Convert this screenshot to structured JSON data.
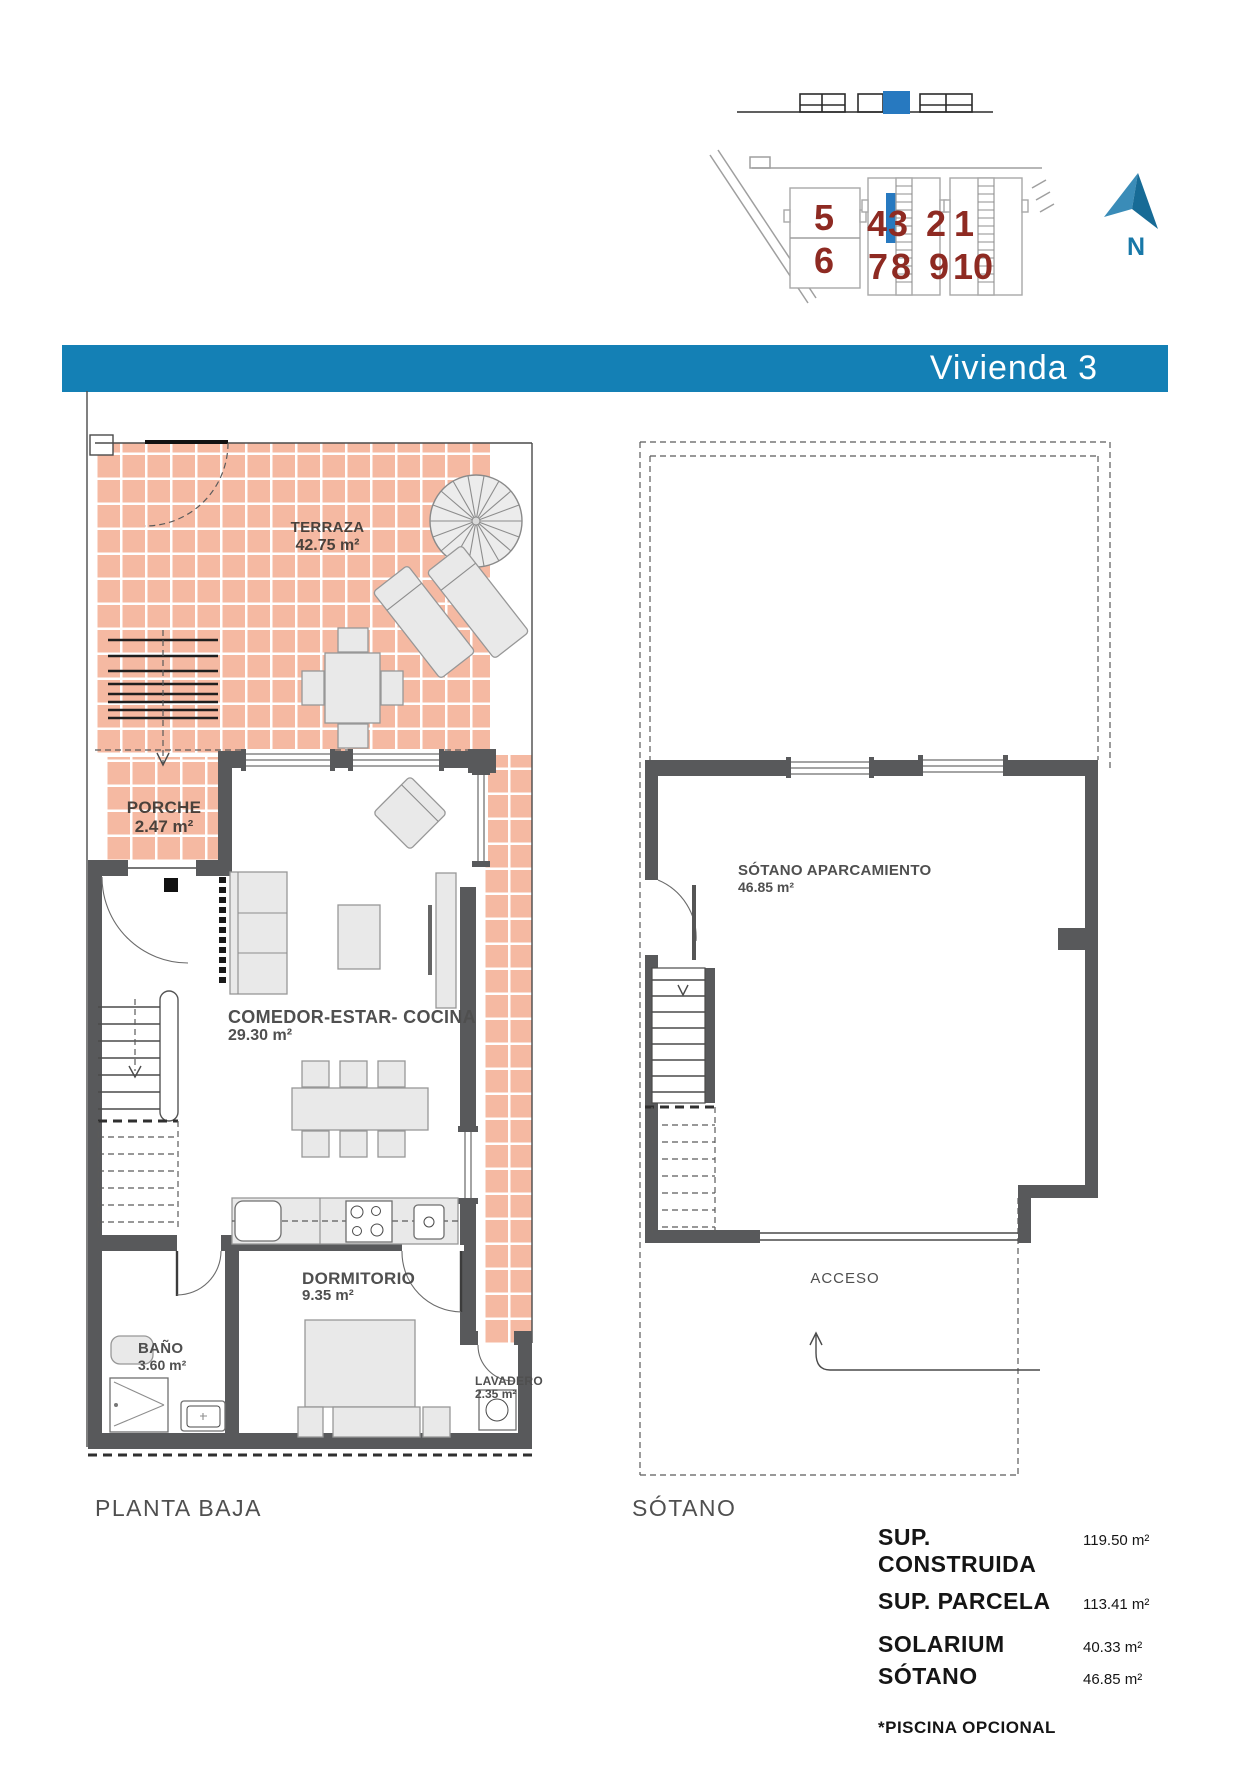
{
  "title_bar": {
    "label": "Vivienda 3"
  },
  "site_plan": {
    "units": [
      {
        "n": "5"
      },
      {
        "n": "6"
      },
      {
        "n": "4"
      },
      {
        "n": "3",
        "highlighted": true
      },
      {
        "n": "7"
      },
      {
        "n": "8"
      },
      {
        "n": "2"
      },
      {
        "n": "1"
      },
      {
        "n": "9"
      },
      {
        "n": "10"
      }
    ],
    "north_label": "N"
  },
  "plans": {
    "planta_baja": {
      "caption": "PLANTA BAJA",
      "rooms": [
        {
          "name": "TERRAZA",
          "area": "42.75 m²"
        },
        {
          "name": "PORCHE",
          "area": "2.47 m²"
        },
        {
          "name": "COMEDOR-ESTAR- COCINA",
          "area": "29.30 m²"
        },
        {
          "name": "DORMITORIO",
          "area": "9.35 m²"
        },
        {
          "name": "BAÑO",
          "area": "3.60 m²"
        },
        {
          "name": "LAVADERO",
          "area": "2.35 m²"
        }
      ]
    },
    "sotano": {
      "caption": "SÓTANO",
      "rooms": [
        {
          "name": "SÓTANO APARCAMIENTO",
          "area": "46.85 m²"
        }
      ],
      "access_label": "ACCESO"
    }
  },
  "summary": {
    "rows": [
      {
        "label": "SUP. CONSTRUIDA",
        "value": "119.50 m²"
      },
      {
        "label": "SUP. PARCELA",
        "value": "113.41 m²"
      },
      {
        "label": "SOLARIUM",
        "value": "40.33 m²"
      },
      {
        "label": "SÓTANO",
        "value": "46.85 m²"
      }
    ],
    "note": "*PISCINA OPCIONAL"
  },
  "colors": {
    "accent_blue": "#1480b5",
    "site_highlight_blue": "#2779c0",
    "north_blue_light": "#3a8cb8",
    "north_blue_dark": "#176b96",
    "unit_number_red": "#8e2a22",
    "wall_gray": "#58595b",
    "tile_salmon": "#f5b9a2"
  }
}
